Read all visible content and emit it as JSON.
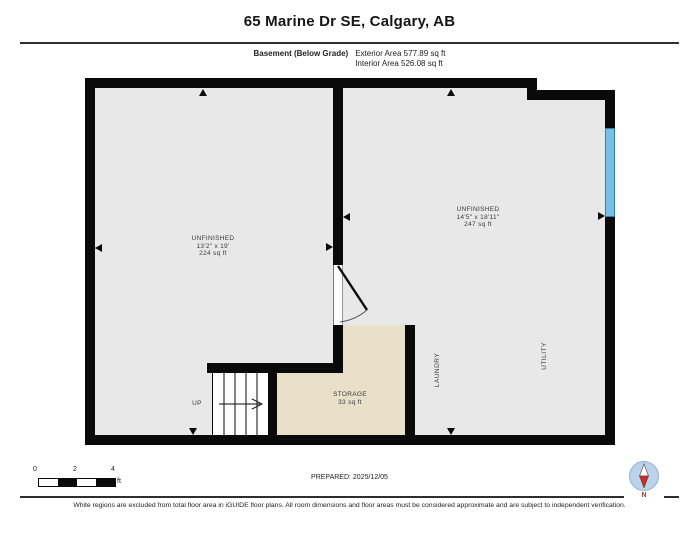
{
  "header": {
    "title": "65 Marine Dr SE, Calgary, AB",
    "floor_label": "Basement (Below Grade)",
    "exterior_area": "Exterior Area 577.89 sq ft",
    "interior_area": "Interior Area 526.08 sq ft"
  },
  "rooms": {
    "left_unfinished": {
      "name": "UNFINISHED",
      "dimensions": "13'2\" x 19'",
      "area": "224 sq ft"
    },
    "right_unfinished": {
      "name": "UNFINISHED",
      "dimensions": "14'5\" x 18'11\"",
      "area": "247 sq ft"
    },
    "storage": {
      "name": "STORAGE",
      "area": "33 sq ft"
    },
    "laundry": {
      "name": "LAUNDRY"
    },
    "utility": {
      "name": "UTILITY"
    },
    "stairs": {
      "label": "UP"
    }
  },
  "scale_bar": {
    "ticks": [
      "0",
      "2",
      "4"
    ],
    "unit": "ft"
  },
  "footer": {
    "prepared": "PREPARED: 2025/12/05",
    "disclaimer": "White regions are excluded from total floor area in iGUIDE floor plans. All room dimensions and floor areas must be considered approximate and are subject to independent verification.",
    "compass_label": "N"
  },
  "colors": {
    "wall": "#0a0a0a",
    "room_fill": "#e8e8e8",
    "storage_fill": "#e9e0c9",
    "window_blue": "#79c1e4",
    "window_border": "#357fa9",
    "compass_circle": "#bad3ea",
    "compass_needle_red": "#c03027"
  }
}
